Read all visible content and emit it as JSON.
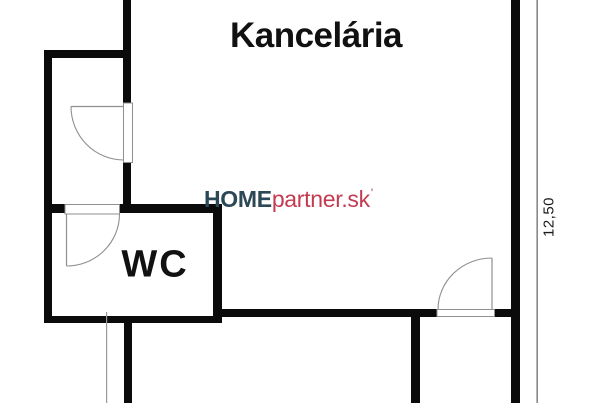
{
  "plan": {
    "rooms": {
      "office": {
        "label": "Kancelária"
      },
      "wc": {
        "label": "WC"
      }
    },
    "dimension": {
      "value": "12,50"
    },
    "watermark": {
      "home": "HOME",
      "partner": "partner.sk",
      "mark": "'"
    },
    "colors": {
      "wall": "#0b0b0b",
      "door_stroke": "#8f8f8f",
      "door_fill": "#ffffff",
      "dimension_line": "#6e6e6e",
      "extension_line": "#9a9a9a",
      "watermark_primary": "#2c4857",
      "watermark_accent": "#c23b51",
      "label_text": "#111111",
      "background": "#ffffff"
    }
  }
}
